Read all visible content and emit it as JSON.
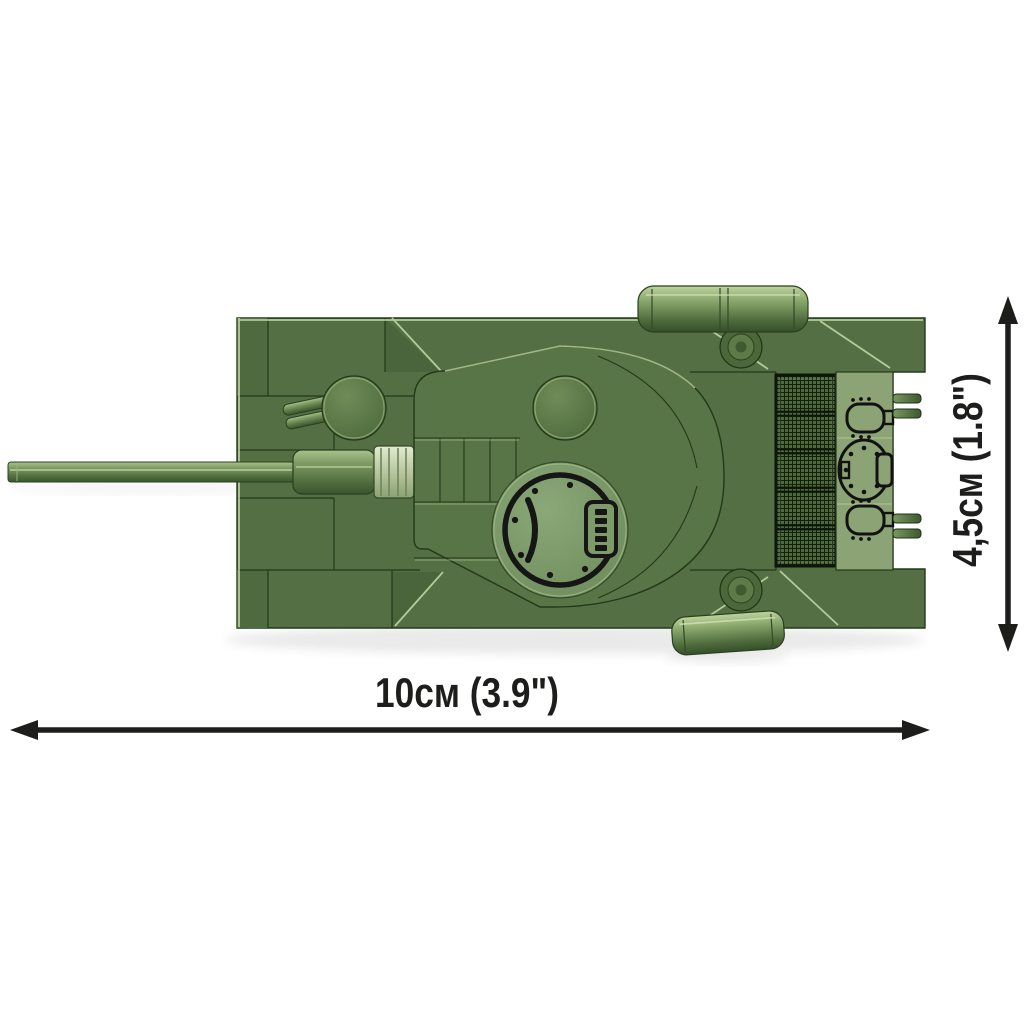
{
  "annotations": {
    "width": {
      "label": "10cм (3.9\")"
    },
    "height": {
      "label": "4,5cм (1.8\")"
    }
  },
  "illustration": {
    "name": "brick-built-tank-top-view",
    "visible_parts": [
      "gun-barrel",
      "gun-mantlet",
      "driver-hatch",
      "turret",
      "turret-hatch",
      "engine-grille",
      "exhaust-plate",
      "fuel-drum-top",
      "fuel-drum-bottom",
      "tow-pins",
      "tracks"
    ]
  },
  "colors": {
    "background": "#ffffff",
    "hull_green": "#546f43",
    "rear_plate_green": "#8ca475",
    "hatch_green": "#7d9a69",
    "highlight_green": "#c6daa8",
    "seam_dark_green": "#1f3215",
    "grille_black": "#0d160a",
    "dimension_color": "#1d1d1b"
  }
}
